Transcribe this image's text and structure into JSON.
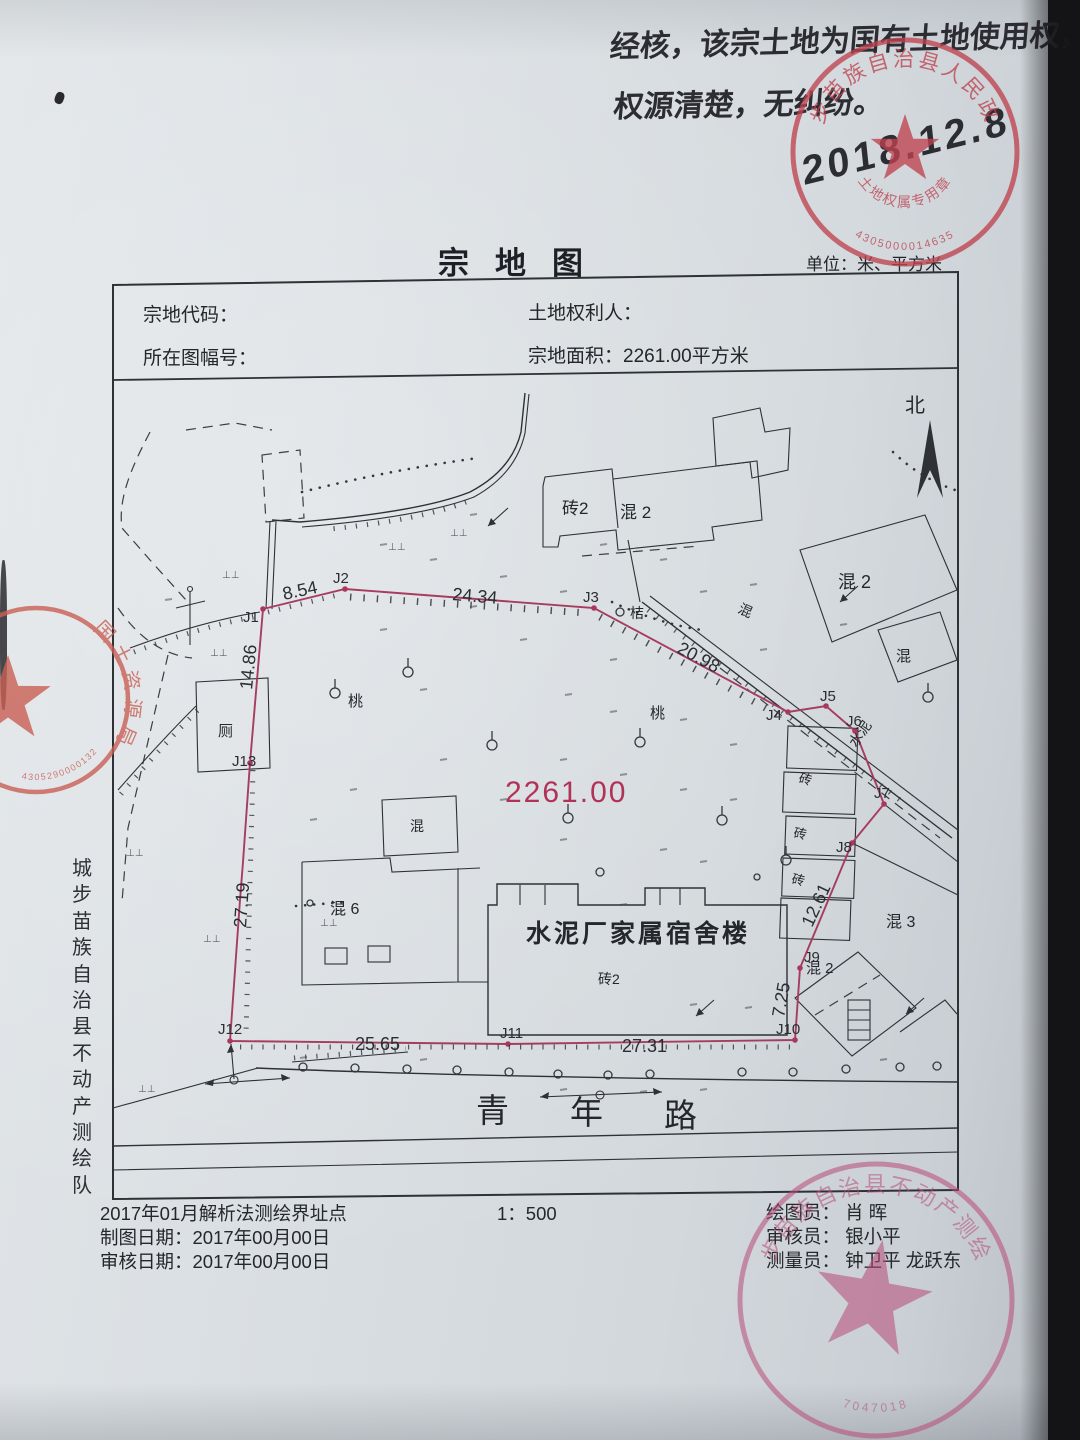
{
  "annotation": {
    "line1": "经核，该宗土地为国有土地使用权，",
    "line2": "权源清楚，无纠纷。",
    "date": "2018.12.8"
  },
  "header": {
    "title": "宗地图",
    "unit_label": "单位：米、平方米"
  },
  "form": {
    "parcel_code_label": "宗地代码：",
    "rights_holder_label": "土地权利人：",
    "sheet_no_label": "所在图幅号：",
    "area_label": "宗地面积：",
    "area_value": "2261.00平方米"
  },
  "map": {
    "north_label": "北",
    "area_value": "2261.00",
    "main_building": "水泥厂家属宿舍楼",
    "labels": {
      "zhuan2_top": "砖2",
      "hun2_top": "混 2",
      "hun2_right": "混 2",
      "hun_right_small": "混",
      "hun_mid": "混",
      "ju": "桔",
      "tao_a": "桃",
      "tao_b": "桃",
      "ce": "厕",
      "hun_left": "混",
      "hun6": "混 6",
      "zhuan_a": "砖",
      "zhuan_b": "砖",
      "zhuan_c": "砖",
      "shuini": "水泥",
      "hun3": "混 3",
      "hun2_br": "混 2",
      "zhuan2_bottom": "砖2",
      "road_c1": "青",
      "road_c2": "年",
      "road_c3": "路"
    },
    "points": {
      "j1": "J1",
      "j2": "J2",
      "j3": "J3",
      "j4": "J4",
      "j5": "J5",
      "j6": "J6",
      "j7": "J7",
      "j8": "J8",
      "j9": "J9",
      "j10": "J10",
      "j11": "J11",
      "j12": "J12",
      "j13": "J13"
    },
    "measurements": {
      "m854": "8.54",
      "m2434": "24.34",
      "m2098": "20.98",
      "m1486": "14.86",
      "m2719": "27.19",
      "m2565": "25.65",
      "m2731": "27.31",
      "m725": "7.25",
      "m1261": "12.61"
    }
  },
  "footer": {
    "method_line": "2017年01月解析法测绘界址点",
    "draw_date_line": "制图日期：2017年00月00日",
    "review_date_line": "审核日期：2017年00月00日",
    "scale": "1：500",
    "drafter_line": "绘图员： 肖  晖",
    "reviewer_line": "审核员： 银小平",
    "surveyor_line": "测量员： 钟卫平  龙跃东"
  },
  "sidebar": {
    "org_vertical": "城步苗族自治县不动产测绘队"
  },
  "seals": {
    "government": {
      "ring_text": "城步苗族自治县人民政府",
      "inner_text": "土地权属专用章",
      "serial": "4305000014635"
    },
    "land_bureau": {
      "ring_text": "国土资源局",
      "serial": "4305290000132"
    },
    "survey_team": {
      "ring_text": "城步苗族自治县不动产测绘队",
      "serial": "7047018"
    }
  }
}
